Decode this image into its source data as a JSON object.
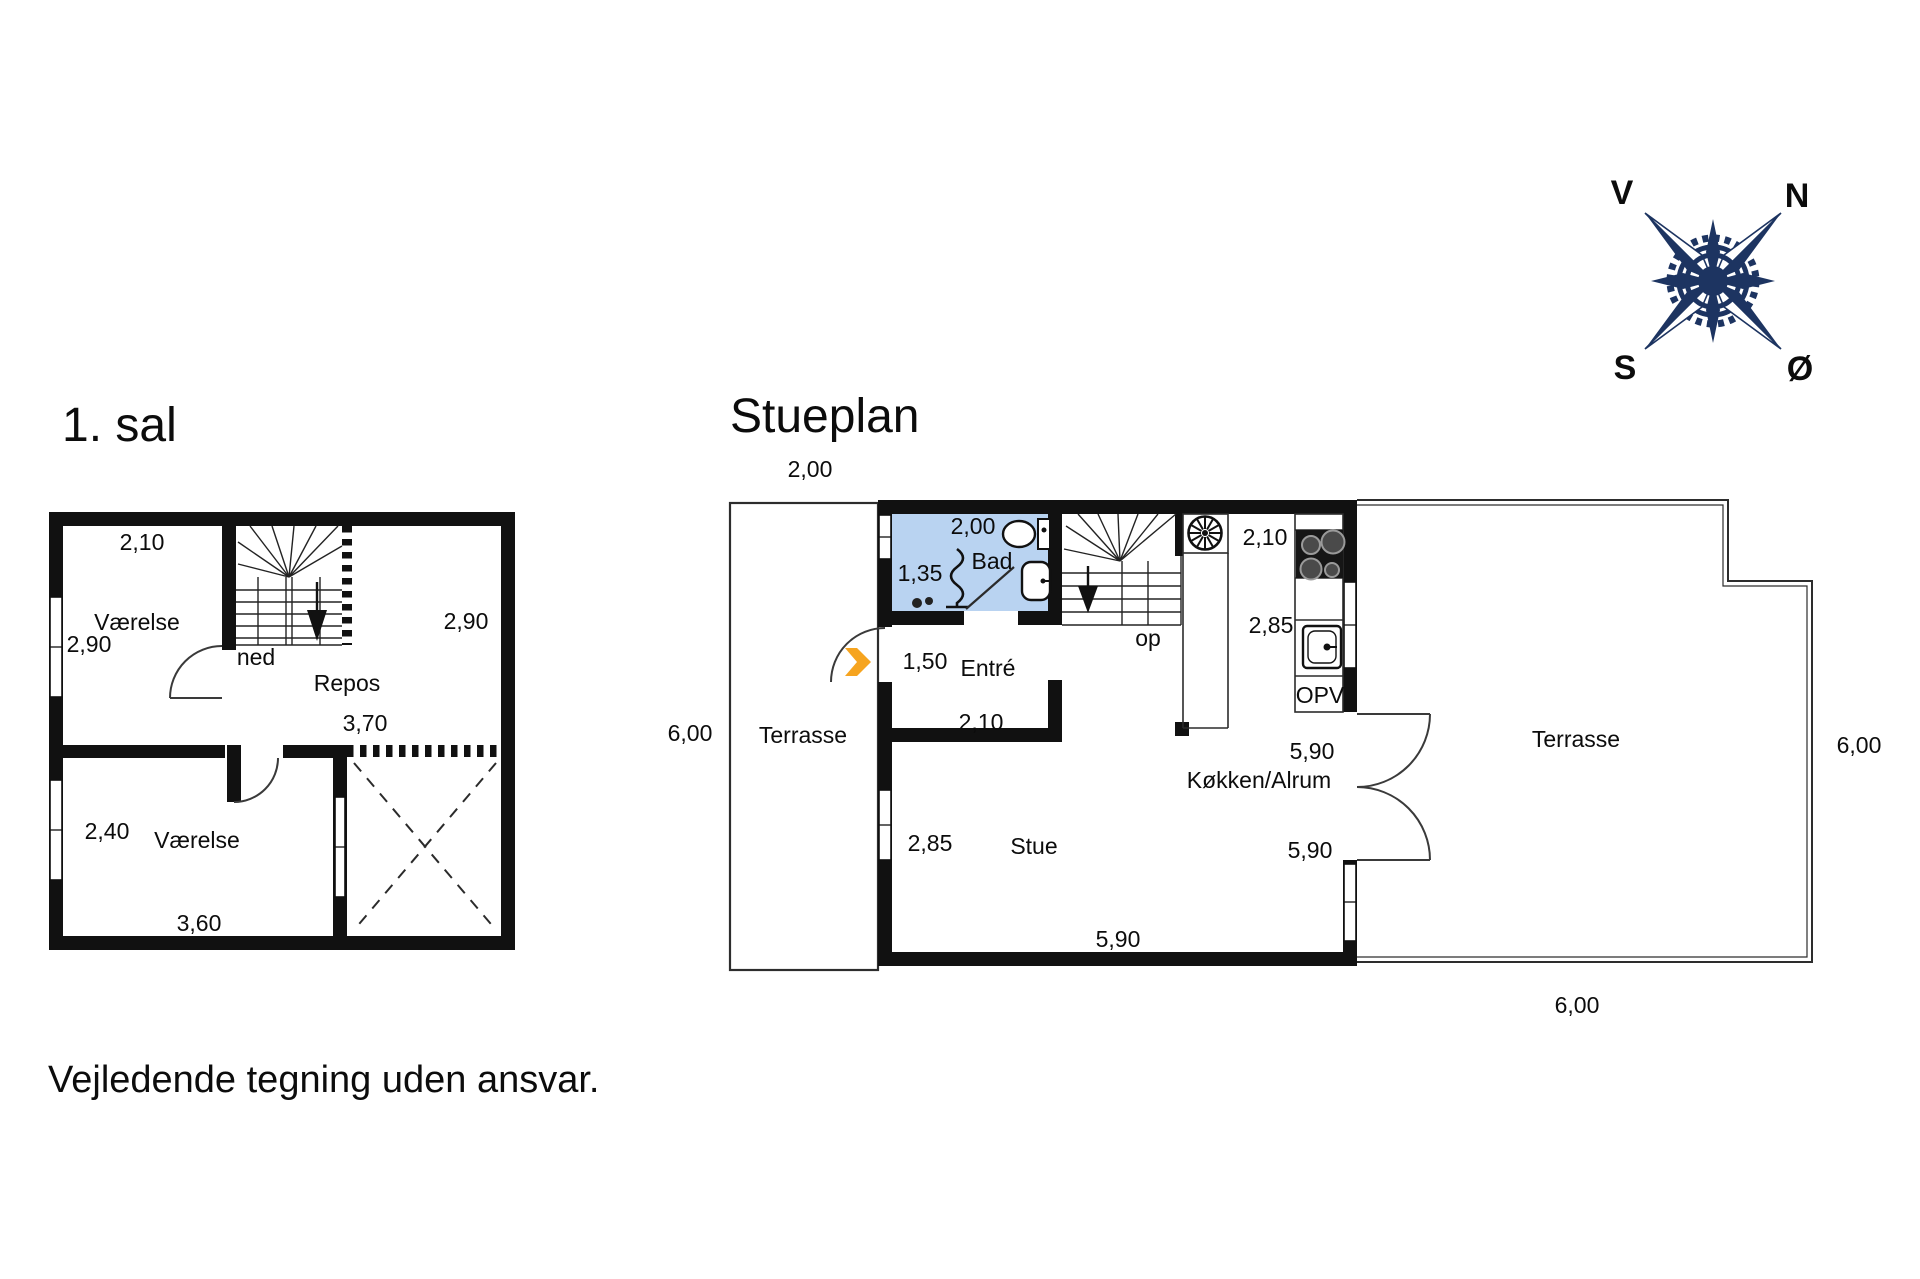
{
  "colors": {
    "wall": "#111111",
    "bath_fill": "#b9d3f1",
    "arrow_orange": "#f6a41f",
    "compass_navy": "#1d3461"
  },
  "titles": {
    "first_floor": "1. sal",
    "ground_floor": "Stueplan"
  },
  "disclaimer": "Vejledende tegning uden ansvar.",
  "compass": {
    "west": "V",
    "north": "N",
    "south": "S",
    "east": "Ø"
  },
  "first_floor": {
    "room_top": {
      "name": "Værelse",
      "width": "2,10",
      "height": "2,90"
    },
    "stair": {
      "label": "ned"
    },
    "landing": {
      "name": "Repos",
      "width": "3,70",
      "height": "2,90"
    },
    "room_bottom": {
      "name": "Værelse",
      "width": "3,60",
      "height": "2,40"
    }
  },
  "ground_floor": {
    "terrace_west": {
      "name": "Terrasse",
      "width": "2,00",
      "height": "6,00"
    },
    "bath": {
      "name": "Bad",
      "width": "2,00",
      "height": "1,35"
    },
    "entry": {
      "name": "Entré",
      "hall_width": "1,50",
      "closet_width": "2,10"
    },
    "stair": {
      "label": "op"
    },
    "kitchen": {
      "name": "Køkken/Alrum",
      "width": "2,10",
      "depth": "2,85",
      "appliance": "OPV",
      "length_top": "5,90",
      "length_bottom": "5,90"
    },
    "living": {
      "name": "Stue",
      "height": "2,85",
      "width": "5,90"
    },
    "terrace_east": {
      "name": "Terrasse",
      "height": "6,00",
      "width": "6,00"
    }
  }
}
